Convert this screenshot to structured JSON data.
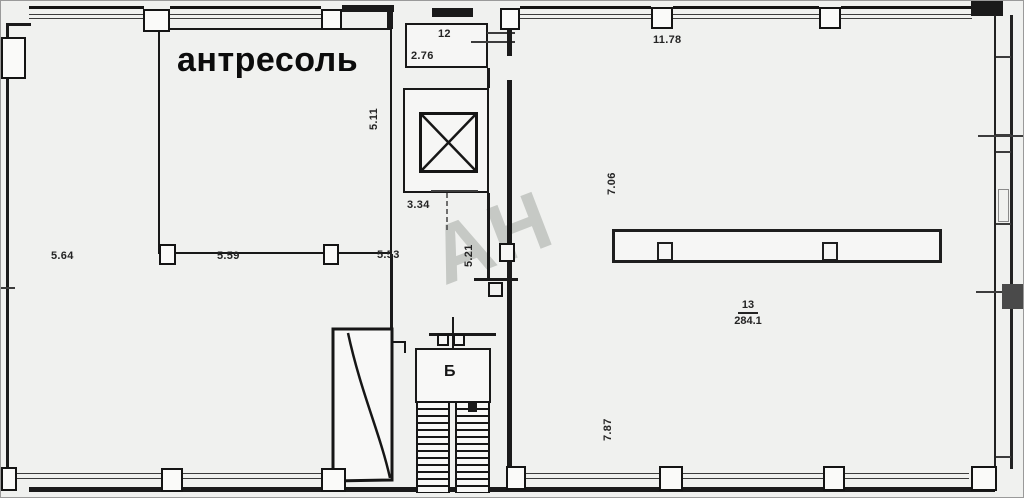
{
  "labels": {
    "mezzanine": "антресоль",
    "stairs": "Б",
    "watermark": "АН"
  },
  "rooms": {
    "room12": {
      "number": "12",
      "area": "2.76"
    },
    "room13": {
      "number": "13",
      "area": "284.1"
    }
  },
  "dimensions": {
    "d5_64": "5.64",
    "d5_59": "5.59",
    "d5_53": "5.53",
    "d5_11": "5.11",
    "d3_34": "3.34",
    "d5_21": "5.21",
    "d11_78": "11.78",
    "d7_06": "7.06",
    "d7_87": "7.87"
  },
  "colors": {
    "line": "#1a1a1a",
    "background": "#f0f1ef",
    "room_fill": "#f6f6f5",
    "watermark": "#c6c9c5",
    "dark_block": "#4a4a4a"
  }
}
